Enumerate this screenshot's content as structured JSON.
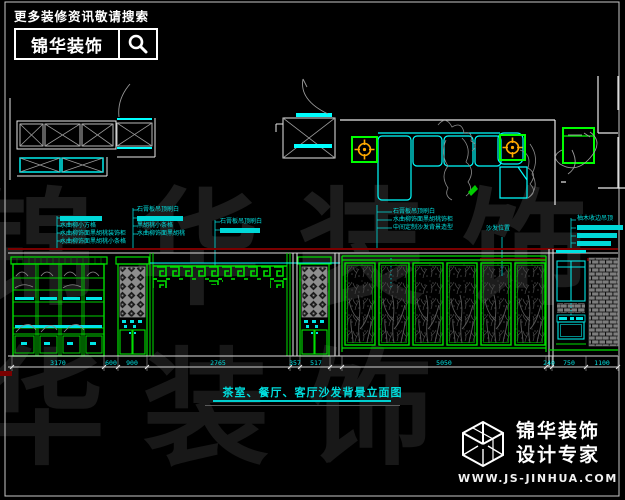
{
  "header": {
    "search_hint": "更多装修资讯敬请搜索",
    "brand": "锦华装饰"
  },
  "watermark": {
    "row1": "锦华装饰",
    "row2": "锦华装饰"
  },
  "annotations": {
    "g1": {
      "lines": [
        "水曲柳小方格",
        "水曲柳饰面黑胡桃装饰柜",
        "水曲柳饰面黑胡桃小条格"
      ]
    },
    "g2": {
      "lines": [
        "石膏板吊顶刷白",
        "黑胡桃小条格",
        "水曲柳饰面黑胡桃"
      ]
    },
    "g3": {
      "lines": [
        "石膏板吊顶刷白"
      ]
    },
    "g4": {
      "lines": [
        "石膏板吊顶刷白",
        "水曲柳饰面黑胡桃饰柜",
        "中间定制沙发背景造型"
      ]
    },
    "g5": {
      "label": "沙发位置"
    },
    "g6": {
      "lines": [
        "柚木收边吊顶"
      ]
    }
  },
  "elevation": {
    "dims": [
      "3170",
      "600",
      "900",
      "2765",
      "357",
      "517",
      "5050",
      "240",
      "750",
      "1100"
    ]
  },
  "drawing_title": "茶室、餐厅、客厅沙发背景立面图",
  "footer": {
    "brand_line1": "锦华装饰",
    "brand_line2": "设计专家",
    "url": "WWW.JS-JINHUA.COM"
  },
  "colors": {
    "cyan": "#00ffff",
    "green": "#00ff00",
    "orange": "#ffaa00",
    "dark_red": "#7a0000"
  }
}
